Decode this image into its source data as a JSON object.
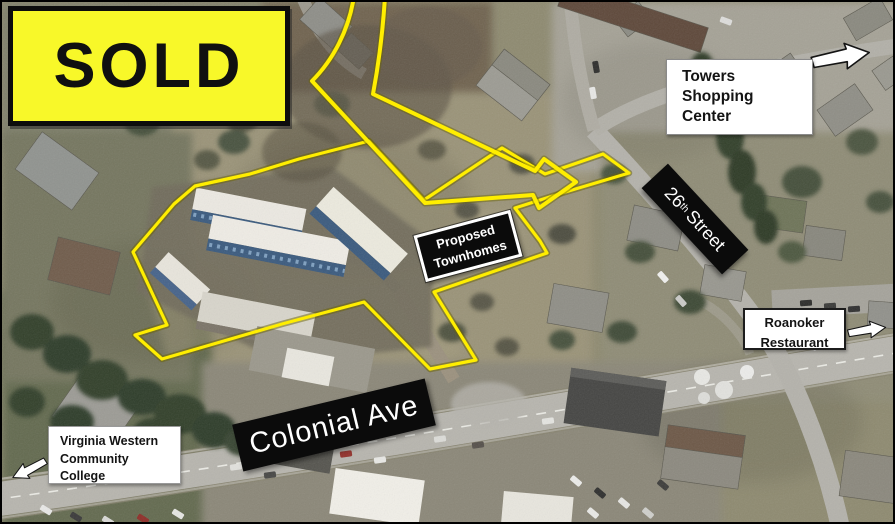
{
  "sold_banner": {
    "text": "SOLD",
    "bg_color": "#f8f829",
    "border_color": "#0d0d0d"
  },
  "labels": {
    "towers": {
      "lines": [
        "Towers",
        "Shopping",
        "Center"
      ]
    },
    "roanoker": {
      "lines": [
        "Roanoker",
        "Restaurant"
      ]
    },
    "vwcc": {
      "lines": [
        "Virginia Western",
        "Community",
        "College"
      ]
    },
    "colonial_ave": {
      "text": "Colonial Ave"
    },
    "street_26": {
      "number": "26",
      "ordinal": "th",
      "name": "Street"
    },
    "proposed": {
      "lines": [
        "Proposed",
        "Townhomes"
      ]
    }
  },
  "annotations": {
    "boundary_color": "#ffee00",
    "pointer_arrow_color": "#ffee00",
    "direction_arrows": [
      {
        "id": "towers-direction",
        "points": "right"
      },
      {
        "id": "roanoker-direction",
        "points": "right"
      },
      {
        "id": "vwcc-direction",
        "points": "left"
      }
    ]
  }
}
